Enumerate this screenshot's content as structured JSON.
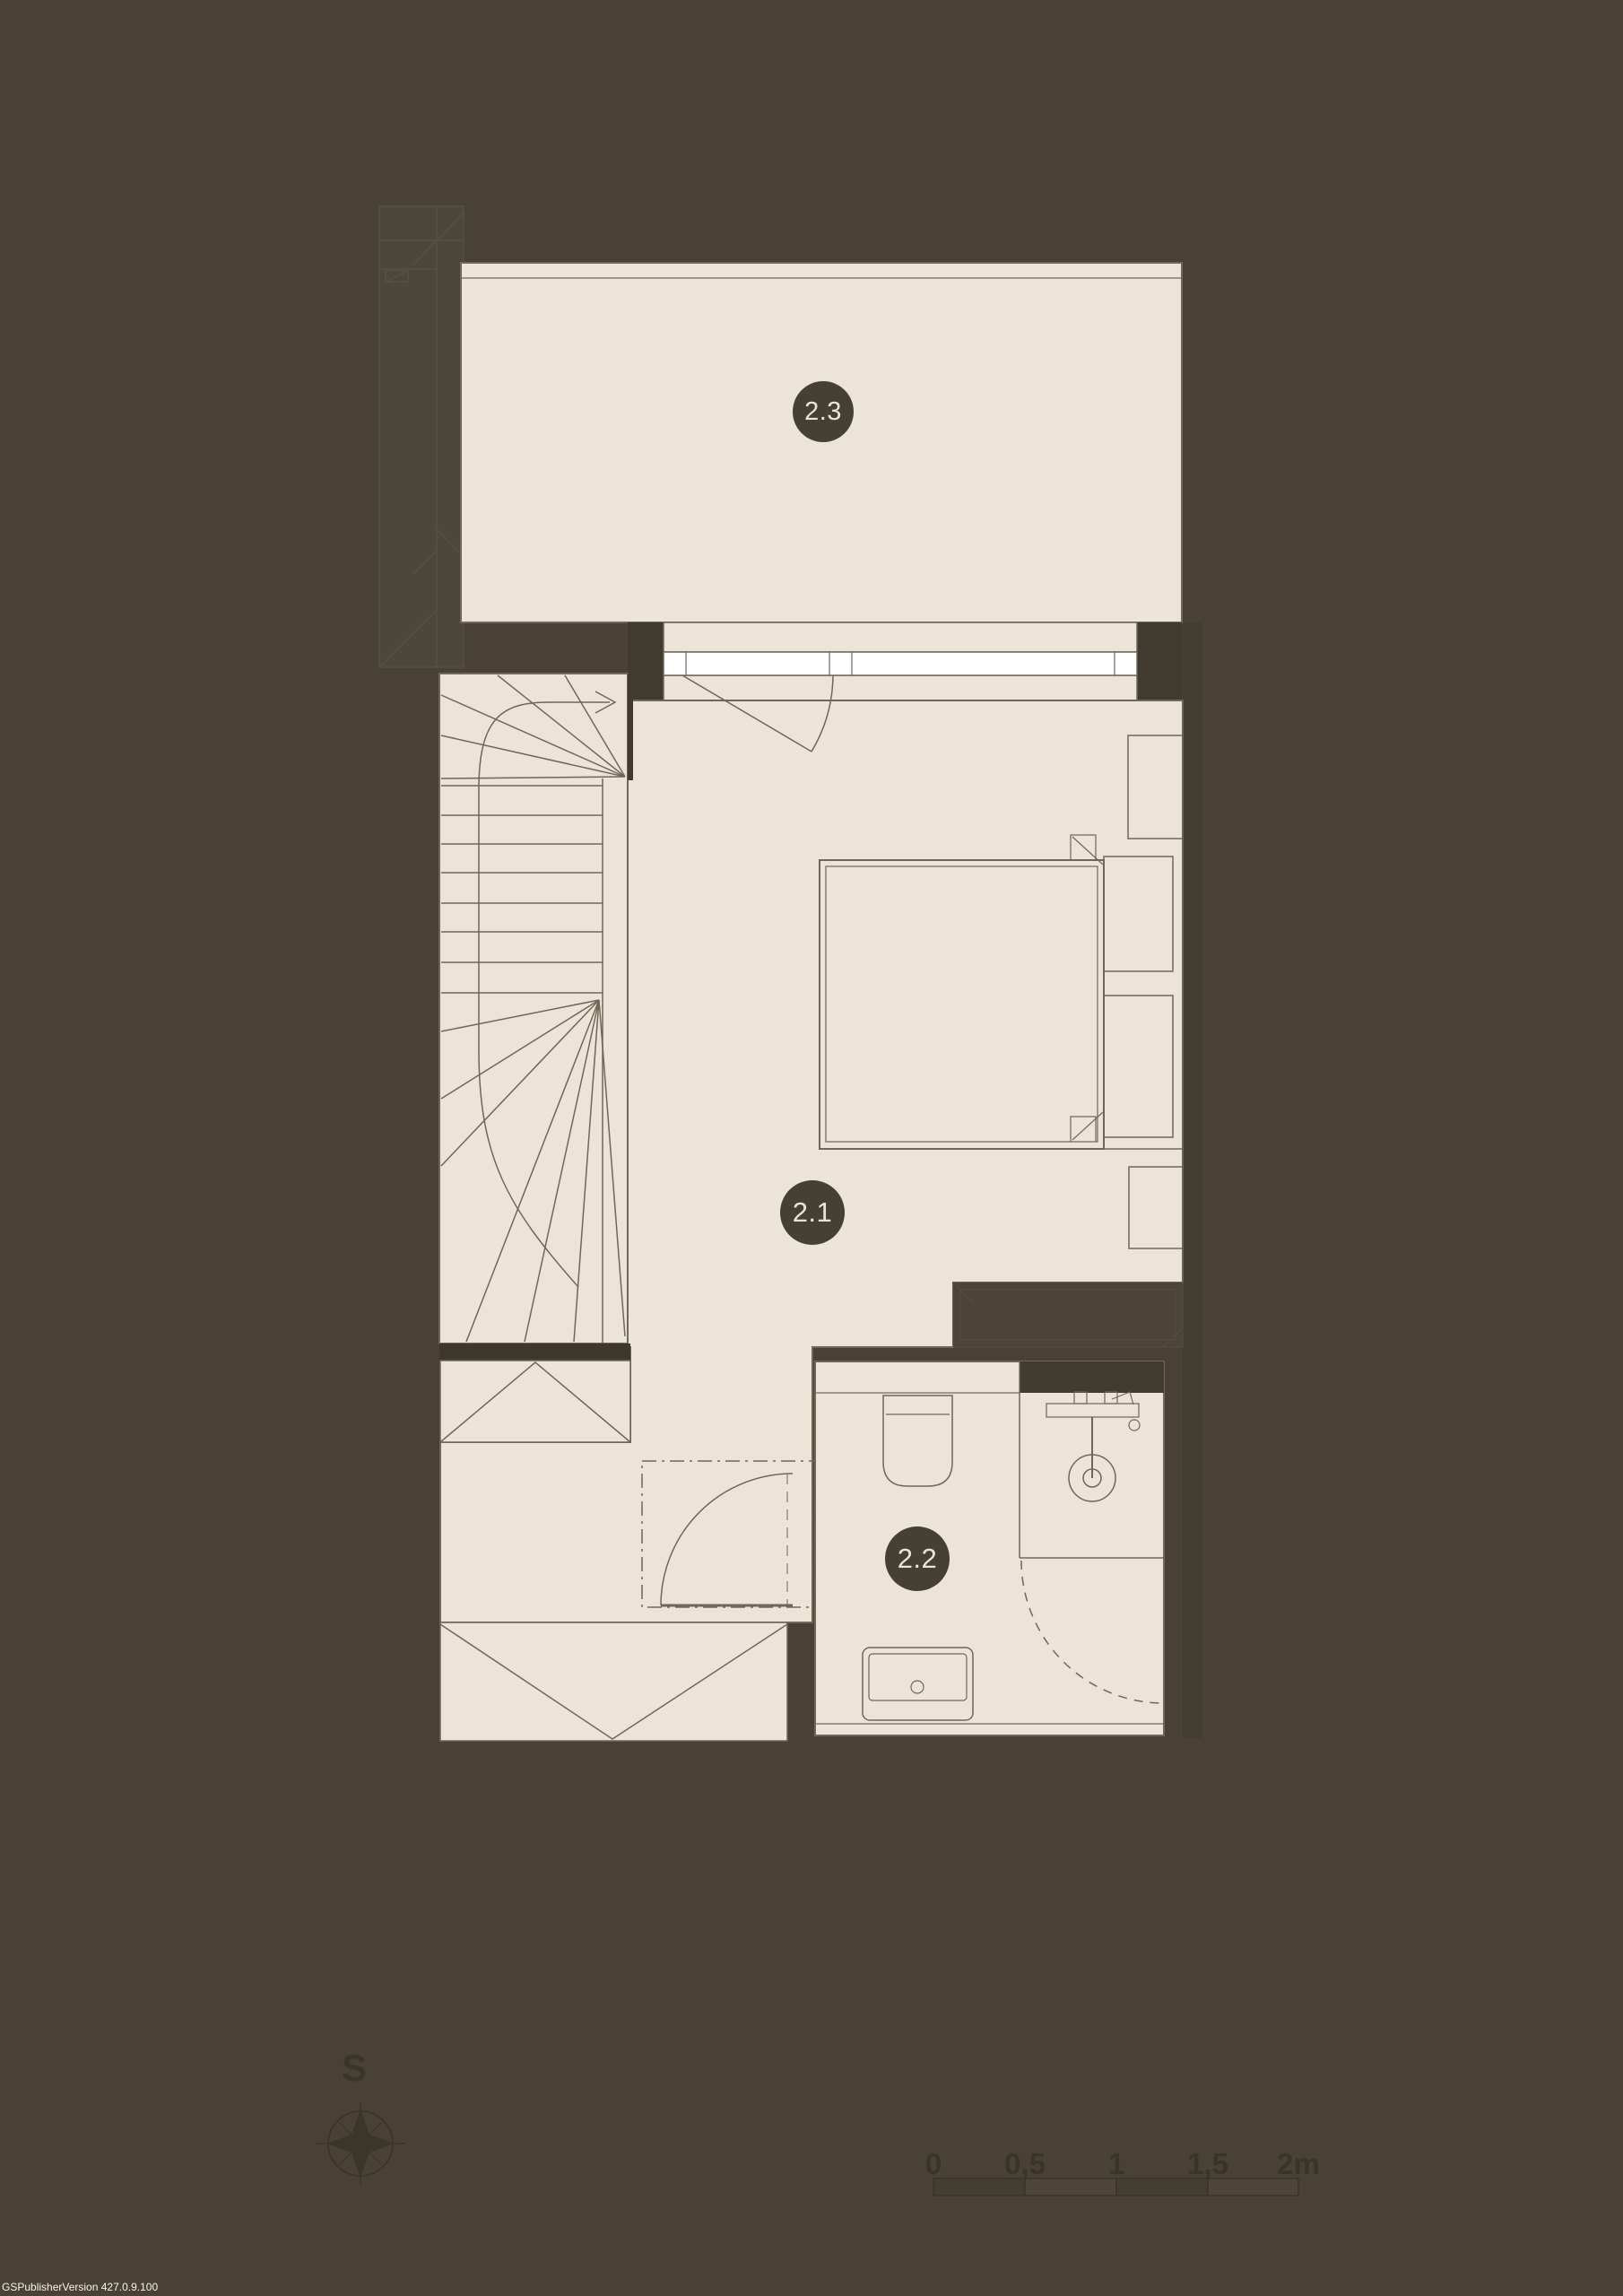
{
  "rooms": [
    {
      "id": "2.3"
    },
    {
      "id": "2.1"
    },
    {
      "id": "2.2"
    }
  ],
  "compass": {
    "label": "S"
  },
  "scale_bar": {
    "ticks": [
      "0",
      "0,5",
      "1",
      "1,5",
      "2m"
    ]
  },
  "watermark": "GSPublisherVersion 427.0.9.100",
  "colors": {
    "background": "#484134",
    "floor": "#ece5d7",
    "line": "#6f6758",
    "wall_dark": "#403a2e",
    "wall_light": "#4b4437",
    "window_white": "#ffffff",
    "badge": "#454031",
    "badge_text": "#ebe4d6",
    "muted_dark": "#3a3428",
    "watermark_text": "#f7f4ec"
  }
}
